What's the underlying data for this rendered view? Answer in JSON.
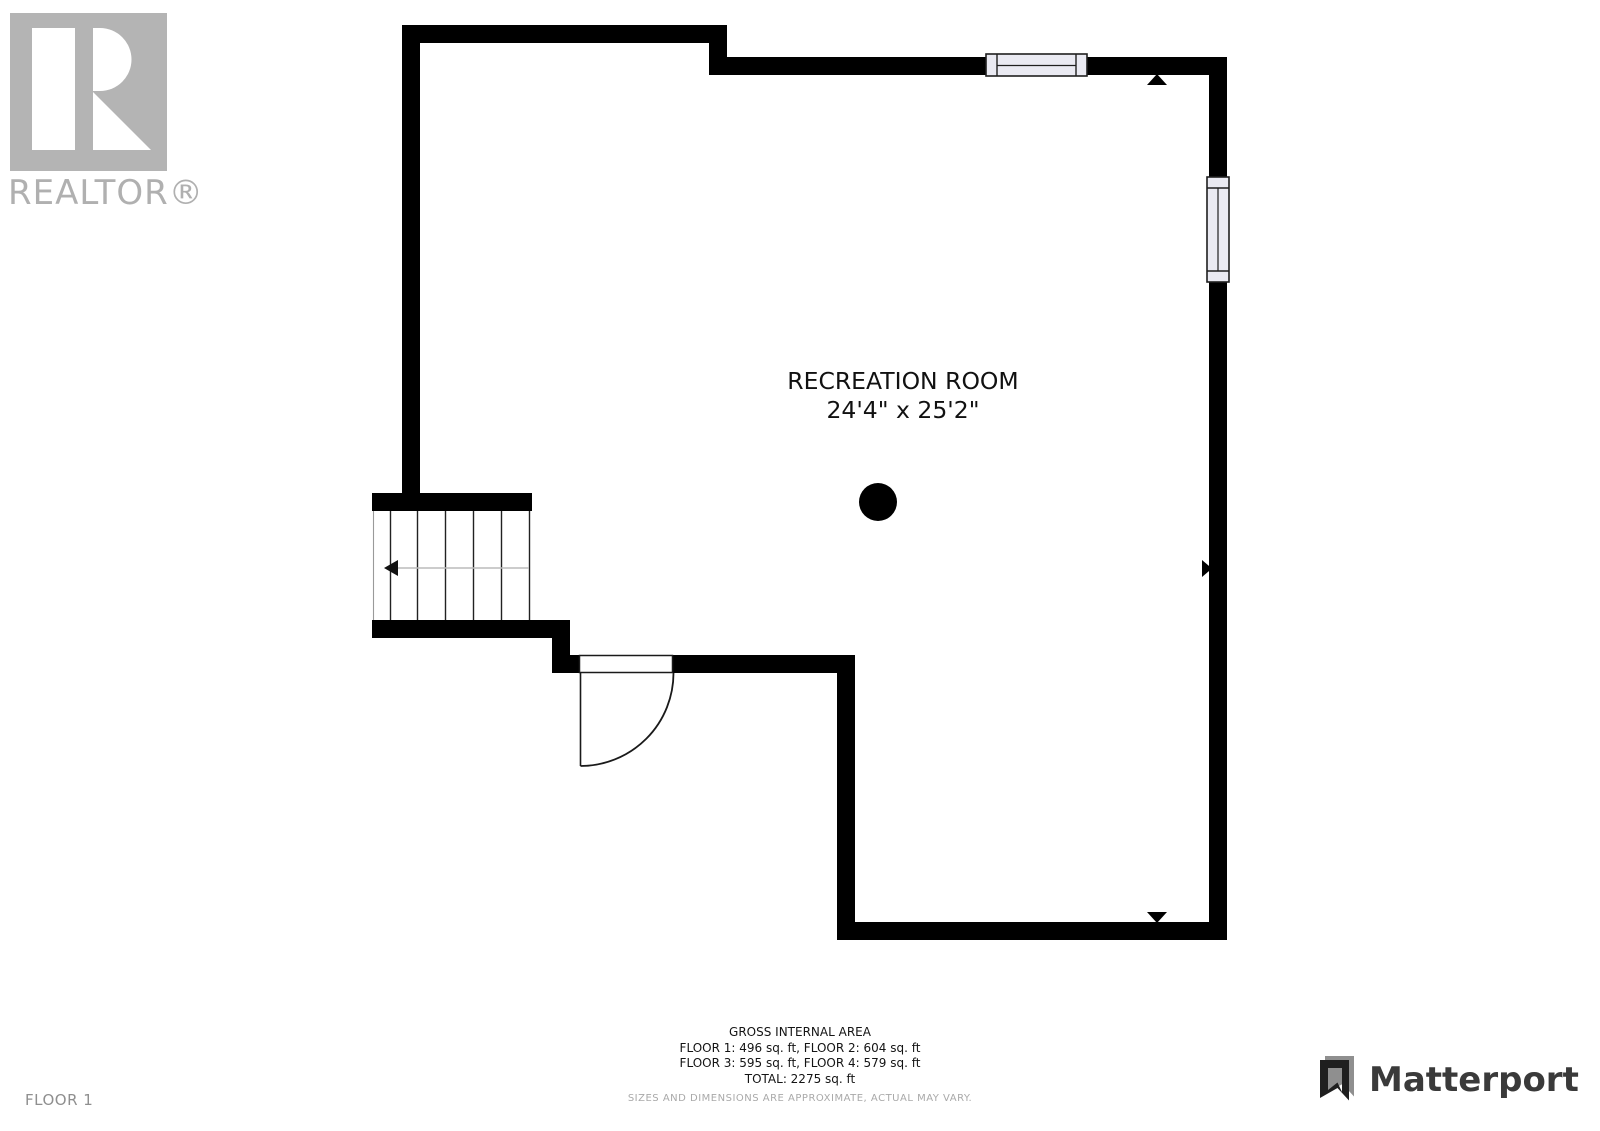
{
  "branding": {
    "realtor_wordmark": "REALTOR®",
    "matterport_wordmark": "Matterport",
    "realtor_logo_color": "#b4b4b4",
    "matterport_text_color": "#3a3a3a"
  },
  "plan": {
    "room_name": "RECREATION ROOM",
    "room_dimensions": "24'4\" x 25'2\"",
    "wall_color": "#000000",
    "window_fill": "#eaeaf2"
  },
  "footer": {
    "floor_label": "FLOOR 1",
    "area_title": "GROSS INTERNAL AREA",
    "area_line_1": "FLOOR 1: 496 sq. ft, FLOOR 2: 604 sq. ft",
    "area_line_2": "FLOOR 3: 595 sq. ft, FLOOR 4: 579 sq. ft",
    "area_total": "TOTAL: 2275 sq. ft",
    "disclaimer": "SIZES AND DIMENSIONS ARE APPROXIMATE, ACTUAL MAY VARY."
  },
  "icons": {
    "realtor_block_r": "realtor-r-icon",
    "matterport_mark": "matterport-m-icon",
    "stair_direction": "stair-direction-arrow-left",
    "entry_markers": [
      "entry-arrow-up",
      "entry-arrow-right",
      "entry-arrow-down"
    ],
    "scan_point": "scan-point-dot"
  }
}
